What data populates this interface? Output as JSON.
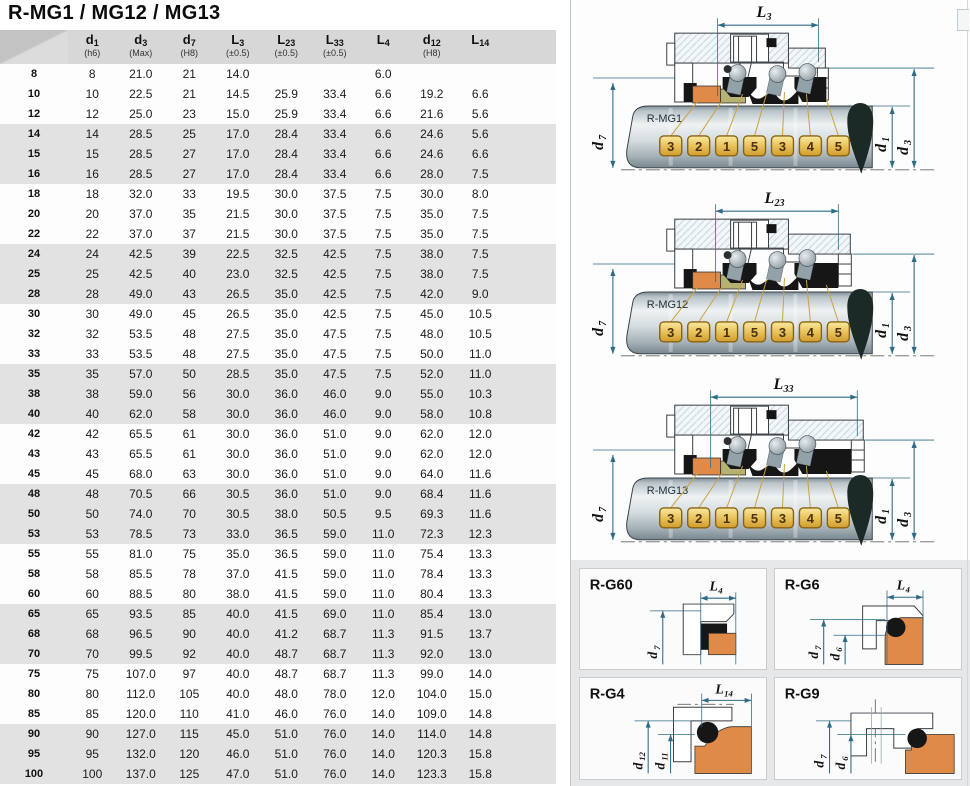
{
  "title": "R-MG1 / MG12 / MG13",
  "table": {
    "columns": [
      {
        "main": "d",
        "sub": "1",
        "note": "(h6)"
      },
      {
        "main": "d",
        "sub": "3",
        "note": "(Max)"
      },
      {
        "main": "d",
        "sub": "7",
        "note": "(H8)"
      },
      {
        "main": "L",
        "sub": "3",
        "note": "(±0.5)"
      },
      {
        "main": "L",
        "sub": "23",
        "note": "(±0.5)"
      },
      {
        "main": "L",
        "sub": "33",
        "note": "(±0.5)"
      },
      {
        "main": "L",
        "sub": "4",
        "note": ""
      },
      {
        "main": "d",
        "sub": "12",
        "note": "(H8)"
      },
      {
        "main": "L",
        "sub": "14",
        "note": ""
      }
    ],
    "rows": [
      [
        "8",
        "8",
        "21.0",
        "21",
        "14.0",
        "",
        "",
        "6.0",
        "",
        ""
      ],
      [
        "10",
        "10",
        "22.5",
        "21",
        "14.5",
        "25.9",
        "33.4",
        "6.6",
        "19.2",
        "6.6"
      ],
      [
        "12",
        "12",
        "25.0",
        "23",
        "15.0",
        "25.9",
        "33.4",
        "6.6",
        "21.6",
        "5.6"
      ],
      [
        "14",
        "14",
        "28.5",
        "25",
        "17.0",
        "28.4",
        "33.4",
        "6.6",
        "24.6",
        "5.6"
      ],
      [
        "15",
        "15",
        "28.5",
        "27",
        "17.0",
        "28.4",
        "33.4",
        "6.6",
        "24.6",
        "6.6"
      ],
      [
        "16",
        "16",
        "28.5",
        "27",
        "17.0",
        "28.4",
        "33.4",
        "6.6",
        "28.0",
        "7.5"
      ],
      [
        "18",
        "18",
        "32.0",
        "33",
        "19.5",
        "30.0",
        "37.5",
        "7.5",
        "30.0",
        "8.0"
      ],
      [
        "20",
        "20",
        "37.0",
        "35",
        "21.5",
        "30.0",
        "37.5",
        "7.5",
        "35.0",
        "7.5"
      ],
      [
        "22",
        "22",
        "37.0",
        "37",
        "21.5",
        "30.0",
        "37.5",
        "7.5",
        "35.0",
        "7.5"
      ],
      [
        "24",
        "24",
        "42.5",
        "39",
        "22.5",
        "32.5",
        "42.5",
        "7.5",
        "38.0",
        "7.5"
      ],
      [
        "25",
        "25",
        "42.5",
        "40",
        "23.0",
        "32.5",
        "42.5",
        "7.5",
        "38.0",
        "7.5"
      ],
      [
        "28",
        "28",
        "49.0",
        "43",
        "26.5",
        "35.0",
        "42.5",
        "7.5",
        "42.0",
        "9.0"
      ],
      [
        "30",
        "30",
        "49.0",
        "45",
        "26.5",
        "35.0",
        "42.5",
        "7.5",
        "45.0",
        "10.5"
      ],
      [
        "32",
        "32",
        "53.5",
        "48",
        "27.5",
        "35.0",
        "47.5",
        "7.5",
        "48.0",
        "10.5"
      ],
      [
        "33",
        "33",
        "53.5",
        "48",
        "27.5",
        "35.0",
        "47.5",
        "7.5",
        "50.0",
        "11.0"
      ],
      [
        "35",
        "35",
        "57.0",
        "50",
        "28.5",
        "35.0",
        "47.5",
        "7.5",
        "52.0",
        "11.0"
      ],
      [
        "38",
        "38",
        "59.0",
        "56",
        "30.0",
        "36.0",
        "46.0",
        "9.0",
        "55.0",
        "10.3"
      ],
      [
        "40",
        "40",
        "62.0",
        "58",
        "30.0",
        "36.0",
        "46.0",
        "9.0",
        "58.0",
        "10.8"
      ],
      [
        "42",
        "42",
        "65.5",
        "61",
        "30.0",
        "36.0",
        "51.0",
        "9.0",
        "62.0",
        "12.0"
      ],
      [
        "43",
        "43",
        "65.5",
        "61",
        "30.0",
        "36.0",
        "51.0",
        "9.0",
        "62.0",
        "12.0"
      ],
      [
        "45",
        "45",
        "68.0",
        "63",
        "30.0",
        "36.0",
        "51.0",
        "9.0",
        "64.0",
        "11.6"
      ],
      [
        "48",
        "48",
        "70.5",
        "66",
        "30.5",
        "36.0",
        "51.0",
        "9.0",
        "68.4",
        "11.6"
      ],
      [
        "50",
        "50",
        "74.0",
        "70",
        "30.5",
        "38.0",
        "50.5",
        "9.5",
        "69.3",
        "11.6"
      ],
      [
        "53",
        "53",
        "78.5",
        "73",
        "33.0",
        "36.5",
        "59.0",
        "11.0",
        "72.3",
        "12.3"
      ],
      [
        "55",
        "55",
        "81.0",
        "75",
        "35.0",
        "36.5",
        "59.0",
        "11.0",
        "75.4",
        "13.3"
      ],
      [
        "58",
        "58",
        "85.5",
        "78",
        "37.0",
        "41.5",
        "59.0",
        "11.0",
        "78.4",
        "13.3"
      ],
      [
        "60",
        "60",
        "88.5",
        "80",
        "38.0",
        "41.5",
        "59.0",
        "11.0",
        "80.4",
        "13.3"
      ],
      [
        "65",
        "65",
        "93.5",
        "85",
        "40.0",
        "41.5",
        "69.0",
        "11.0",
        "85.4",
        "13.0"
      ],
      [
        "68",
        "68",
        "96.5",
        "90",
        "40.0",
        "41.2",
        "68.7",
        "11.3",
        "91.5",
        "13.7"
      ],
      [
        "70",
        "70",
        "99.5",
        "92",
        "40.0",
        "48.7",
        "68.7",
        "11.3",
        "92.0",
        "13.0"
      ],
      [
        "75",
        "75",
        "107.0",
        "97",
        "40.0",
        "48.7",
        "68.7",
        "11.3",
        "99.0",
        "14.0"
      ],
      [
        "80",
        "80",
        "112.0",
        "105",
        "40.0",
        "48.0",
        "78.0",
        "12.0",
        "104.0",
        "15.0"
      ],
      [
        "85",
        "85",
        "120.0",
        "110",
        "41.0",
        "46.0",
        "76.0",
        "14.0",
        "109.0",
        "14.8"
      ],
      [
        "90",
        "90",
        "127.0",
        "115",
        "45.0",
        "51.0",
        "76.0",
        "14.0",
        "114.0",
        "14.8"
      ],
      [
        "95",
        "95",
        "132.0",
        "120",
        "46.0",
        "51.0",
        "76.0",
        "14.0",
        "120.3",
        "15.8"
      ],
      [
        "100",
        "100",
        "137.0",
        "125",
        "47.0",
        "51.0",
        "76.0",
        "14.0",
        "123.3",
        "15.8"
      ]
    ]
  },
  "diagrams": [
    {
      "name": "R-MG1",
      "dim_top": {
        "main": "L",
        "sub": "3"
      },
      "callouts": [
        "3",
        "2",
        "1",
        "5",
        "3",
        "4",
        "5"
      ],
      "dim_left": {
        "main": "d",
        "sub": "7"
      },
      "dim_inner": {
        "main": "d",
        "sub": "1"
      },
      "dim_outer": {
        "main": "d",
        "sub": "3"
      }
    },
    {
      "name": "R-MG12",
      "dim_top": {
        "main": "L",
        "sub": "23"
      },
      "callouts": [
        "3",
        "2",
        "1",
        "5",
        "3",
        "4",
        "5"
      ],
      "dim_left": {
        "main": "d",
        "sub": "7"
      },
      "dim_inner": {
        "main": "d",
        "sub": "1"
      },
      "dim_outer": {
        "main": "d",
        "sub": "3"
      }
    },
    {
      "name": "R-MG13",
      "dim_top": {
        "main": "L",
        "sub": "33"
      },
      "callouts": [
        "3",
        "2",
        "1",
        "5",
        "3",
        "4",
        "5"
      ],
      "dim_left": {
        "main": "d",
        "sub": "7"
      },
      "dim_inner": {
        "main": "d",
        "sub": "1"
      },
      "dim_outer": {
        "main": "d",
        "sub": "3"
      }
    }
  ],
  "panels": [
    {
      "name": "R-G60",
      "dim_top": {
        "main": "L",
        "sub": "4"
      },
      "dims_left": [
        {
          "main": "d",
          "sub": "7"
        }
      ]
    },
    {
      "name": "R-G6",
      "dim_top": {
        "main": "L",
        "sub": "4"
      },
      "dims_left": [
        {
          "main": "d",
          "sub": "7"
        },
        {
          "main": "d",
          "sub": "6"
        }
      ]
    },
    {
      "name": "R-G4",
      "dim_top": {
        "main": "L",
        "sub": "14"
      },
      "dims_left": [
        {
          "main": "d",
          "sub": "12"
        },
        {
          "main": "d",
          "sub": "11"
        }
      ]
    },
    {
      "name": "R-G9",
      "dims_left": [
        {
          "main": "d",
          "sub": "7"
        },
        {
          "main": "d",
          "sub": "6"
        }
      ]
    }
  ],
  "colors": {
    "header_gray": "#d7d7d7",
    "row_shaded": "#e2e2e2",
    "dim_line": "#2f6b86",
    "callout_gold": "#e9c35c",
    "part_orange": "#e08a4a",
    "part_olive": "#b5b273",
    "shaft_steel": "#c6d0d4",
    "panel_bg": "#e5e7e9"
  }
}
